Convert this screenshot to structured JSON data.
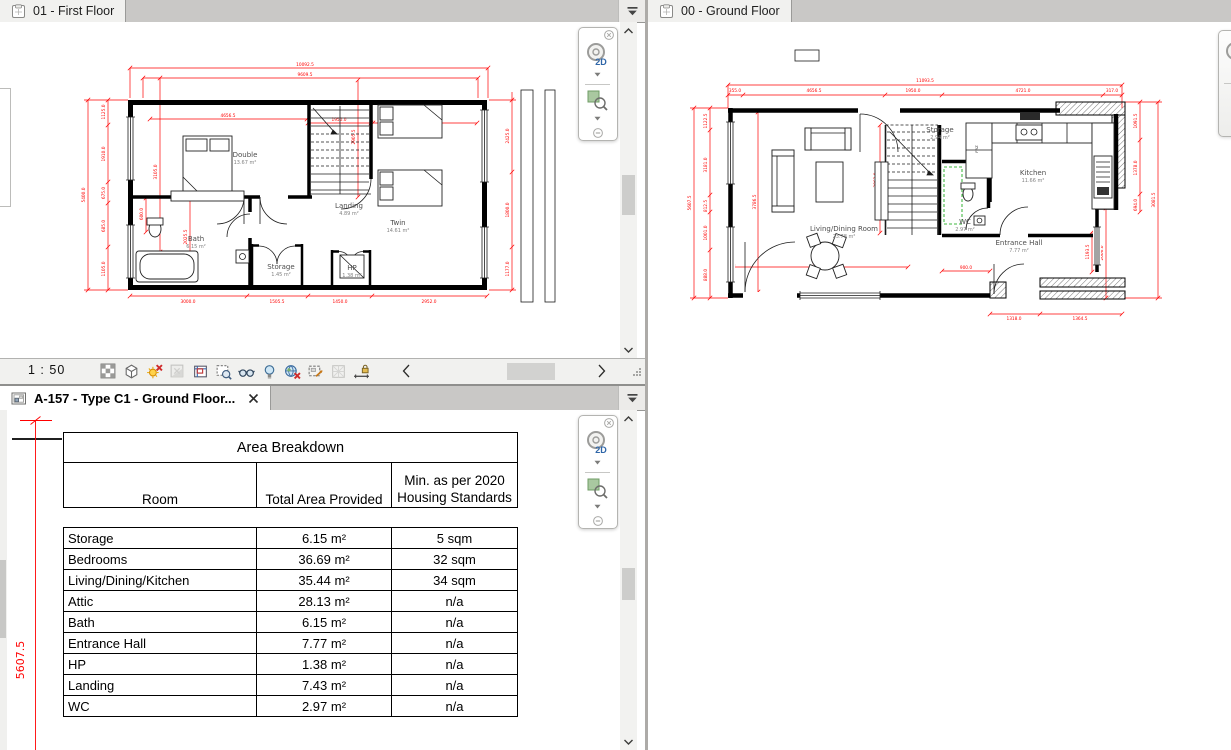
{
  "panels": {
    "first_floor": {
      "tab_label": "01 - First Floor",
      "view_control": {
        "scale": "1 : 50"
      },
      "rooms": [
        {
          "name": "Double",
          "area": "13.67 m²"
        },
        {
          "name": "Twin",
          "area": "14.61 m²"
        },
        {
          "name": "Bath",
          "area": "6.15 m²"
        },
        {
          "name": "Storage",
          "area": "1.45 m²"
        },
        {
          "name": "Landing",
          "area": "4.89 m²"
        },
        {
          "name": "HP",
          "area": "1.38 m²"
        }
      ],
      "dims": {
        "top": [
          "10092.5",
          "9609.5"
        ],
        "left": [
          "1125.0",
          "1910.0",
          "675.0",
          "685.0",
          "1105.0"
        ],
        "left_overall": "5400.0",
        "right": [
          "2425.0",
          "1800.0",
          "1177.0"
        ],
        "bottom": [
          "3000.0",
          "1505.5",
          "1450.0",
          "2952.0"
        ],
        "inner_h": [
          "4656.5",
          "1950.0",
          "2952.0"
        ],
        "inner_v": [
          "2905.5",
          "3105.0",
          "2025.5",
          "600.0"
        ]
      }
    },
    "ground_floor": {
      "tab_label": "00 - Ground Floor",
      "rooms": [
        {
          "name": "Living/Dining Room",
          "area": "23.78 m²"
        },
        {
          "name": "Storage",
          "area": "2.94 m²"
        },
        {
          "name": "Kitchen",
          "area": "11.66 m²"
        },
        {
          "name": "WC",
          "area": "2.97 m²"
        },
        {
          "name": "Entrance Hall",
          "area": "7.77 m²"
        }
      ],
      "labels": {
        "frz": "FRZ"
      },
      "dims": {
        "top_overall": "11093.5",
        "top": [
          "355.0",
          "4656.5",
          "1950.0",
          "4721.0",
          "317.0"
        ],
        "left": [
          "1122.5",
          "3181.0",
          "812.5",
          "1001.0",
          "888.0"
        ],
        "left_overall": "5607.5",
        "right": [
          "1091.5",
          "1378.0",
          "694.0",
          "1193.5",
          "2006.0"
        ],
        "right_overall": "3081.5",
        "bottom": [
          "4656.5",
          "900.0",
          "1318.0",
          "1364.5"
        ],
        "inner_v": [
          "3786.5",
          "2063.0"
        ]
      }
    },
    "sheet": {
      "tab_label": "A-157 - Type C1 - Ground Floor...",
      "dim_left": "5607.5",
      "table": {
        "title": "Area Breakdown",
        "col_room": "Room",
        "col_total": "Total Area Provided",
        "col_min": "Min. as per 2020 Housing Standards",
        "rows": [
          {
            "room": "Storage",
            "total": "6.15 m²",
            "min": "5 sqm"
          },
          {
            "room": "Bedrooms",
            "total": "36.69 m²",
            "min": "32 sqm"
          },
          {
            "room": "Living/Dining/Kitchen",
            "total": "35.44 m²",
            "min": "34 sqm"
          },
          {
            "room": "Attic",
            "total": "28.13 m²",
            "min": "n/a"
          },
          {
            "room": "Bath",
            "total": "6.15 m²",
            "min": "n/a"
          },
          {
            "room": "Entrance Hall",
            "total": "7.77 m²",
            "min": "n/a"
          },
          {
            "room": "HP",
            "total": "1.38 m²",
            "min": "n/a"
          },
          {
            "room": "Landing",
            "total": "7.43 m²",
            "min": "n/a"
          },
          {
            "room": "WC",
            "total": "2.97 m²",
            "min": "n/a"
          }
        ]
      }
    }
  },
  "navigation_bar": {
    "wheel_label": "2D"
  },
  "view_control_bar": {
    "scale": "1 : 50",
    "icons": [
      "detail-level",
      "visual-style",
      "sun-path",
      "shadows",
      "crop-view",
      "show-crop-region",
      "temporary-hide-isolate",
      "reveal-hidden-elements",
      "worksharing-display",
      "temporary-view-properties",
      "analytical-model",
      "reveal-constraints"
    ]
  },
  "colors": {
    "dimension_red": "#ff0000",
    "wc_clearance_green": "#00a000",
    "canvas": "#ffffff"
  }
}
